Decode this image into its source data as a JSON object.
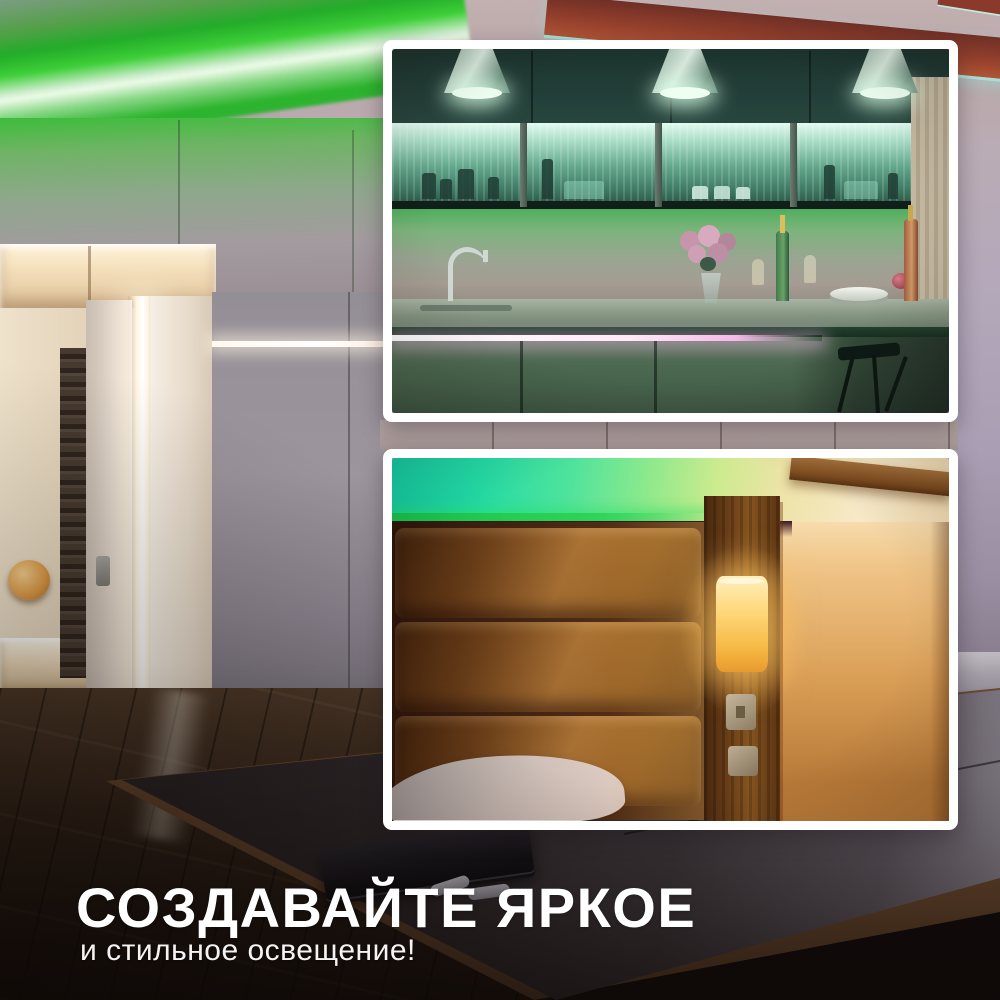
{
  "headline": "СОЗДАВАЙТЕ ЯРКОЕ",
  "subheadline": "и стильное освещение!",
  "colors": {
    "led_green": "#35cd3a",
    "led_mint": "#d6efdc",
    "led_teal": "#2be0c0",
    "led_magenta": "#f6b8e8",
    "warm_light": "#f6b944",
    "beam_red": "#933f2c",
    "frame_white": "#ffffff",
    "text": "#ffffff"
  },
  "scenes": {
    "background": "living room with green LED ceiling cove lighting",
    "inset_top": "kitchen with green LED under-cabinet lighting",
    "inset_bottom": "bedroom with green LED cove and warm wall sconce"
  }
}
